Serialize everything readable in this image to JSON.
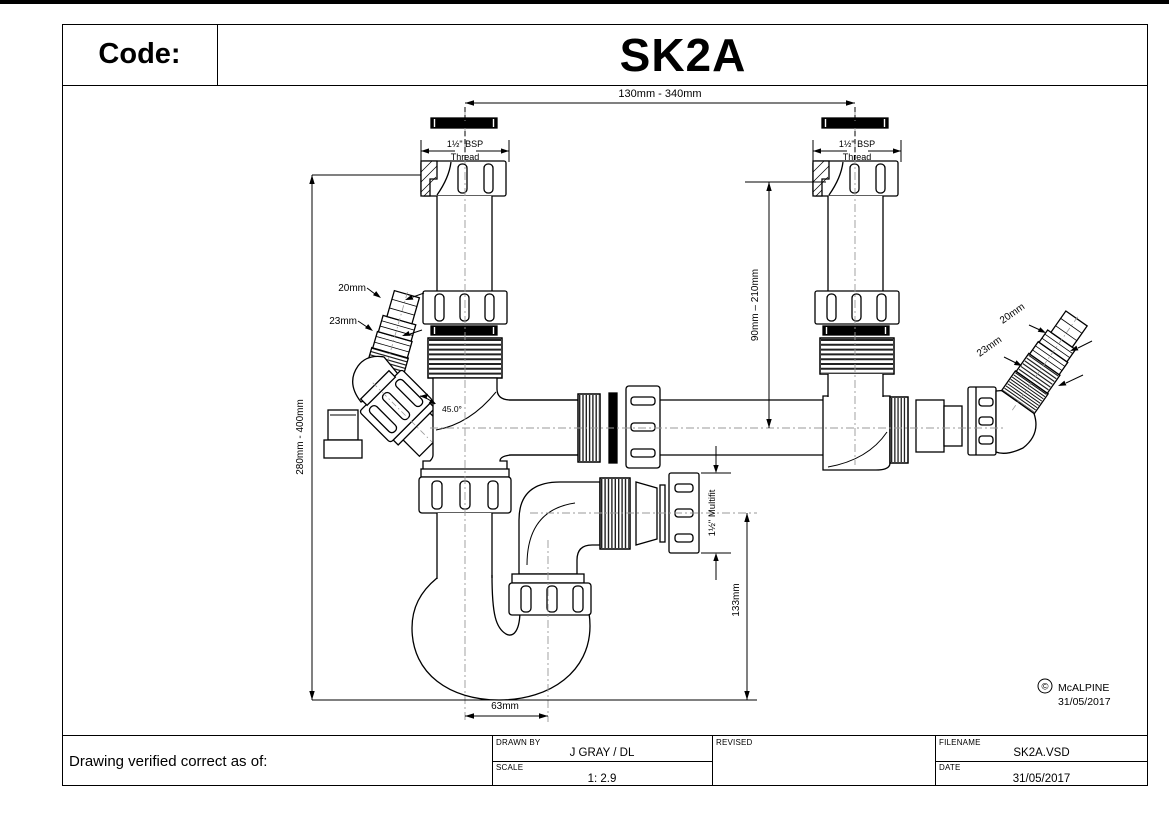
{
  "title_block": {
    "code_label": "Code:",
    "code_value": "SK2A"
  },
  "drawing": {
    "dim_top_width": "130mm - 340mm",
    "bsp_left_line1": "1½\" BSP",
    "bsp_left_line2": "Thread",
    "bsp_right_line1": "1½\" BSP",
    "bsp_right_line2": "Thread",
    "dim_left_height": "280mm - 400mm",
    "dim_right_height": "90mm – 210mm",
    "dim_angle": "45.0°",
    "hose_left_dia_small": "20mm",
    "hose_left_dia_large": "23mm",
    "hose_right_dia_small": "20mm",
    "hose_right_dia_large": "23mm",
    "dim_outlet": "1½\" Multifit",
    "dim_trap_depth": "133mm",
    "dim_trap_width": "63mm",
    "copyright_symbol": "©",
    "copyright_name": "McALPINE",
    "copyright_date": "31/05/2017"
  },
  "footer_block": {
    "verified_label": "Drawing verified  correct as of:",
    "drawn_by_label": "DRAWN BY",
    "drawn_by_value": "J GRAY / DL",
    "scale_label": "SCALE",
    "scale_value": "1: 2.9",
    "revised_label": "REVISED",
    "filename_label": "FILENAME",
    "filename_value": "SK2A.VSD",
    "date_label": "DATE",
    "date_value": "31/05/2017"
  }
}
